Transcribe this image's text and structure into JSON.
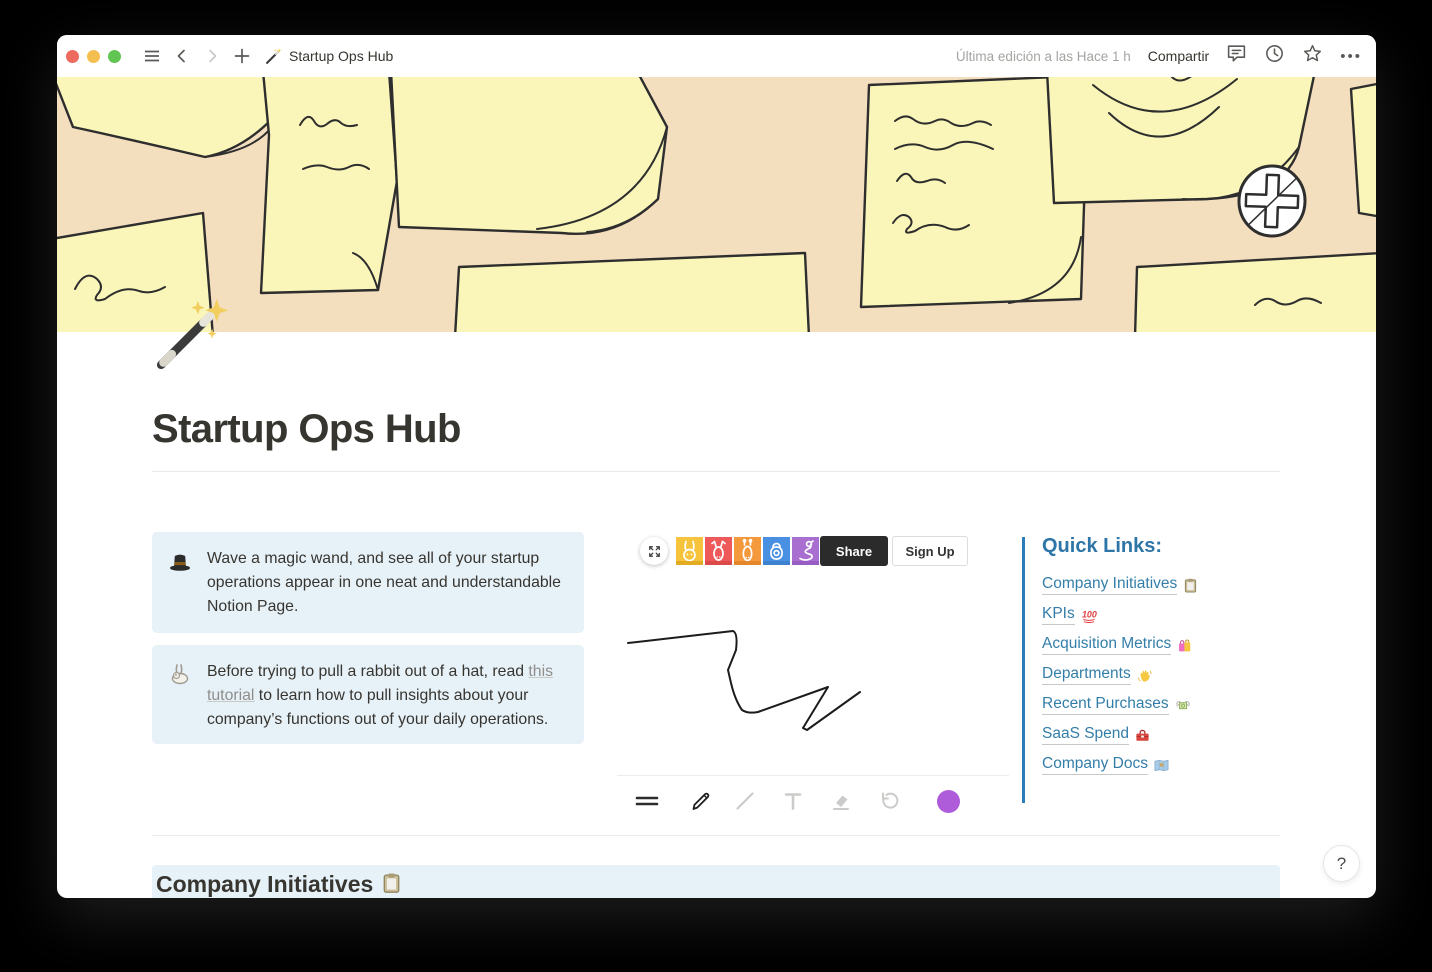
{
  "titlebar": {
    "page_title": "Startup Ops Hub",
    "page_icon": "🪄",
    "last_edited": "Última edición a las Hace 1 h",
    "share_label": "Compartir",
    "more_label": "•••"
  },
  "page": {
    "icon": "🪄",
    "title": "Startup Ops Hub"
  },
  "callouts": [
    {
      "icon": "🎩",
      "text": "Wave a magic wand, and see all of your startup operations appear in one neat and understandable Notion Page."
    },
    {
      "icon": "🐇",
      "text_before": "Before trying to pull a rabbit out of a hat, read ",
      "link_text": "this tutorial",
      "text_after": " to learn how to pull insights about your company’s functions out of your daily operations."
    }
  ],
  "whiteboard": {
    "share_label": "Share",
    "signup_label": "Sign Up",
    "avatars": [
      {
        "name": "rabbit",
        "color": "#F6C33C"
      },
      {
        "name": "deer",
        "color": "#EE5A5A"
      },
      {
        "name": "giraffe",
        "color": "#F5993D"
      },
      {
        "name": "hedgehog",
        "color": "#4A90E2"
      },
      {
        "name": "snake",
        "color": "#A86FD1"
      }
    ],
    "pen_color": "#AE5CD9"
  },
  "quick_links": {
    "heading": "Quick Links:",
    "links": [
      {
        "label": "Company Initiatives",
        "emoji": "📋"
      },
      {
        "label": "KPIs",
        "emoji": "💯"
      },
      {
        "label": "Acquisition Metrics",
        "emoji": "🛍️"
      },
      {
        "label": "Departments",
        "emoji": "👋"
      },
      {
        "label": "Recent Purchases",
        "emoji": "💸"
      },
      {
        "label": "SaaS Spend",
        "emoji": "🧰"
      },
      {
        "label": "Company Docs",
        "emoji": "🗺️"
      }
    ]
  },
  "section_heading": {
    "label": "Company Initiatives",
    "emoji": "📋"
  },
  "help_button": {
    "label": "?"
  },
  "colors": {
    "link_blue": "#337EA9",
    "quote_bar_blue": "#2D7CB8",
    "callout_bg": "#E7F1F8",
    "cover_bg": "#F3DEBE",
    "note_yellow": "#FAF6B9",
    "share_button_bg": "#2B2B2B",
    "pen_purple": "#AE5CD9"
  }
}
